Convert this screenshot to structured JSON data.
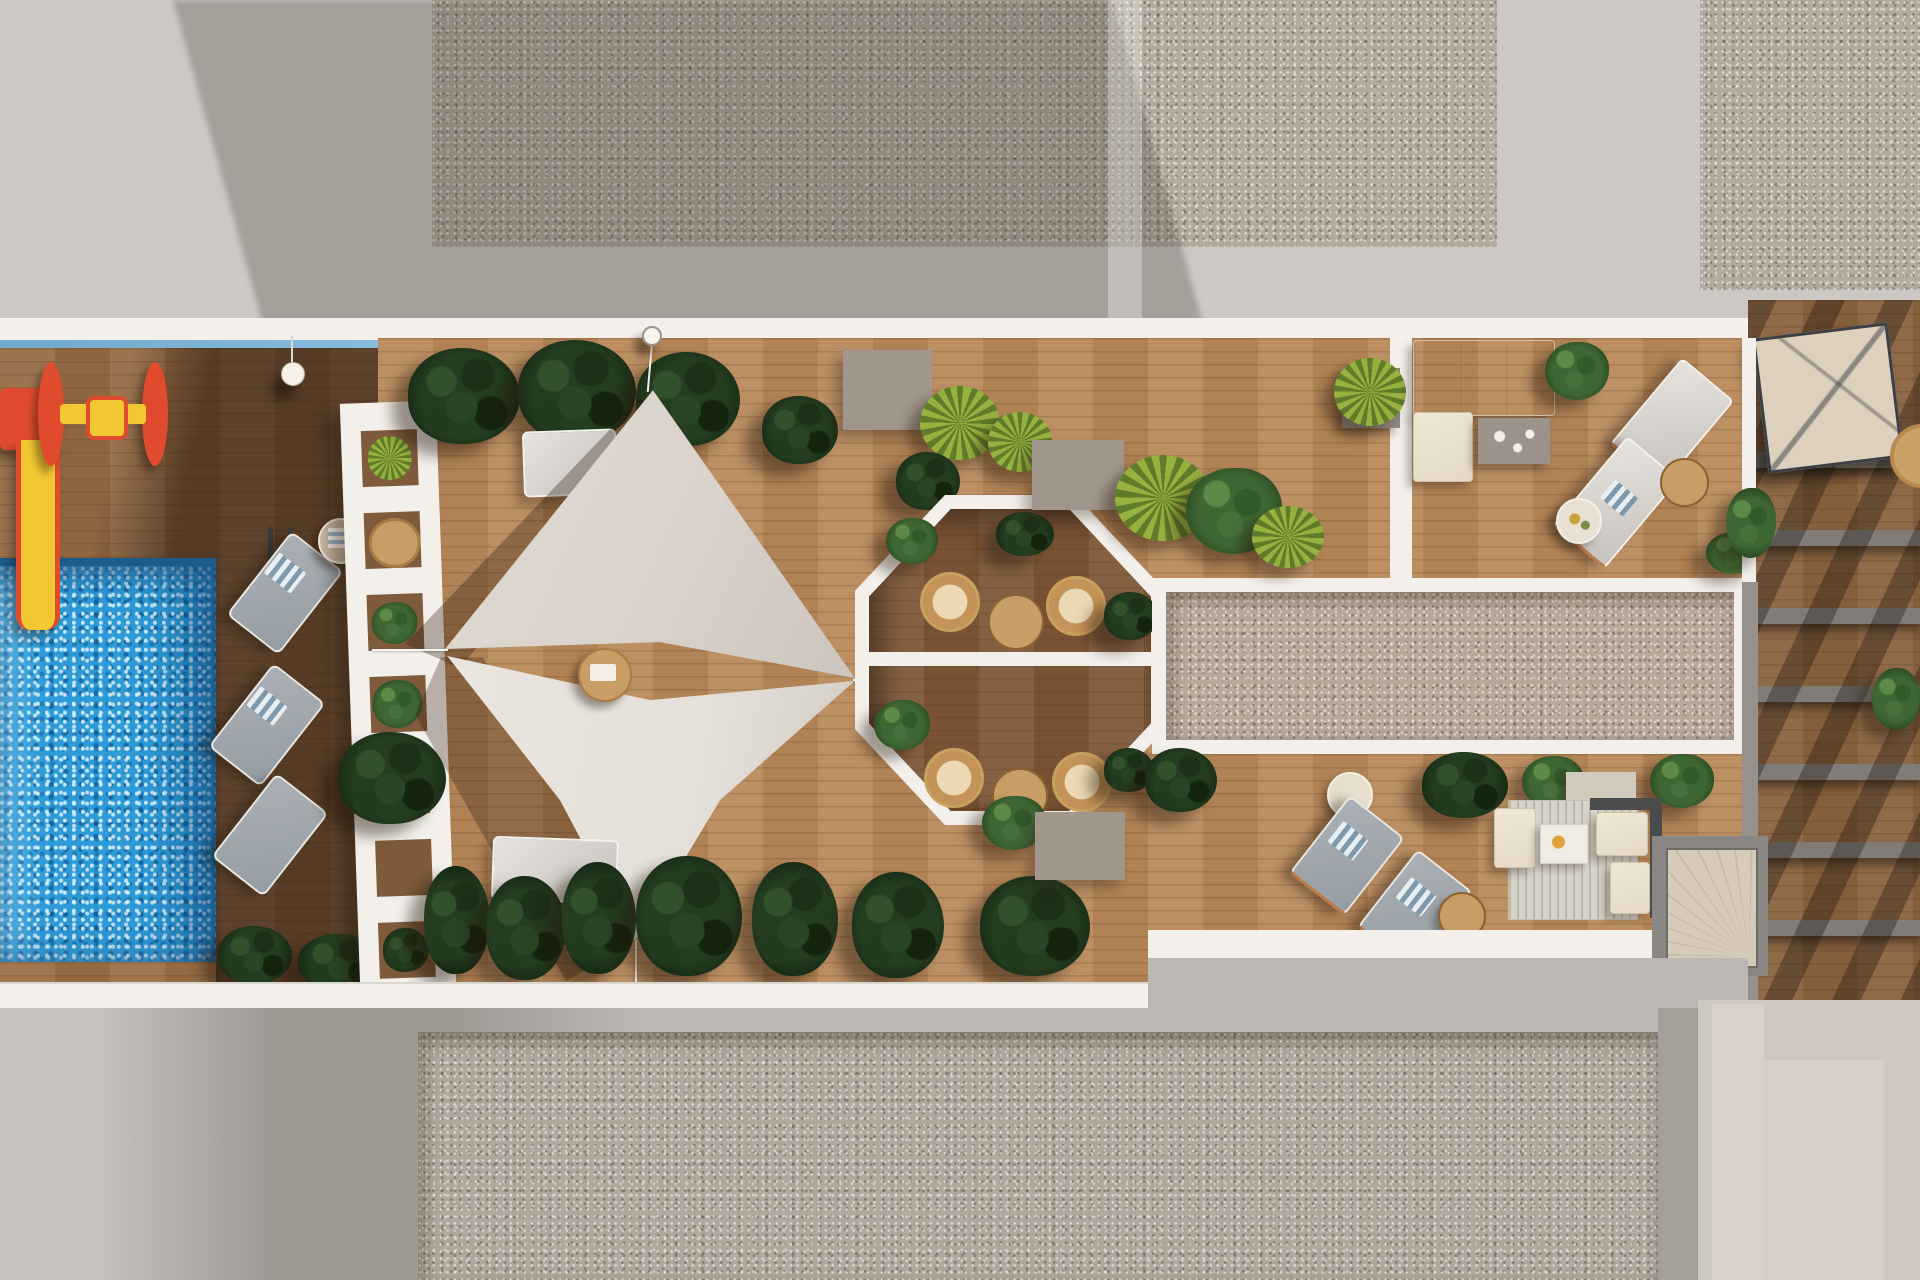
{
  "meta": {
    "scene": "top-down 3D architectural render of a residential rooftop amenity terrace",
    "view": "aerial plan view",
    "visible_text": "none"
  },
  "palette": {
    "concrete_light": "#cdc8c3",
    "concrete_shadow": "#9d9894",
    "white": "#f3f0eb",
    "glass_blue": "#7db6d8",
    "gravel_top": "#b3a99d",
    "gravel_pink": "#b7a89a",
    "gravel_bottom": "#b1a79c",
    "wood_sun": "#b9895a",
    "wood_left": "#966b45",
    "wood_oct": "#7d5636",
    "wood_strip": "#9a6f46",
    "wood_shaded": "#7f5b3c",
    "pool_blue": "#2d9bd8",
    "pool_edge": "#1a5d8c",
    "sail_upper": "#d9d3cb",
    "sail_lower": "#e4dfd8",
    "plant_dark": "#243d20",
    "plant_green": "#3f6733",
    "plant_palm": "#97b13f",
    "lounger_gray": "#959da4",
    "sofa_beige": "#e3d9c6",
    "taupe_block": "#a1968c",
    "rattan": "#c49357",
    "table_wood": "#c89d66",
    "slide_red": "#e04b2e",
    "slide_yellow": "#f2c832",
    "beam_gray": "#8e8a87",
    "frame_dark": "#4a4b4d",
    "stair_beige": "#d6cbba",
    "panel_light": "#cfc8bf"
  },
  "scene": {
    "areas": [
      {
        "name": "swimming-pool",
        "feature": "sparkling blue water, ladder, yellow slide"
      },
      {
        "name": "kids-playground",
        "feature": "red and yellow slide and roller toy on dark wood deck"
      },
      {
        "name": "pool-lounger-row",
        "feature": "three gray sun loungers with striped towels and side table"
      },
      {
        "name": "white-pergola-screen",
        "feature": "white ladder-like planter screen with plants and table"
      },
      {
        "name": "shade-sail-deck",
        "feature": "two triangular canvas sails over light wood deck with white loungers"
      },
      {
        "name": "octagon-dining-pavilion",
        "feature": "white octagonal frame, rattan chairs, round tables, hedges"
      },
      {
        "name": "framed-gravel-roof",
        "feature": "long white-framed gravel rectangle"
      },
      {
        "name": "upper-lounge-terrace",
        "feature": "L-shaped sofa, coffee table, two chaise lounges, palms"
      },
      {
        "name": "lower-lounge-terrace",
        "feature": "corner sofa on striped rug, two gray loungers, round tables"
      },
      {
        "name": "private-terraces-strip",
        "feature": "wood decks with gray pergola beams, awning and stair, right edge"
      },
      {
        "name": "surrounding-roofs",
        "feature": "plain concrete and speckled gravel roof fields with long diagonal shadows"
      }
    ],
    "object_counts": {
      "shade_sails": 2,
      "gray_loungers": 5,
      "white_loungers": 4,
      "rattan_chairs": 4,
      "round_tables": 8,
      "plants": 25,
      "taupe_blocks": 3
    }
  }
}
